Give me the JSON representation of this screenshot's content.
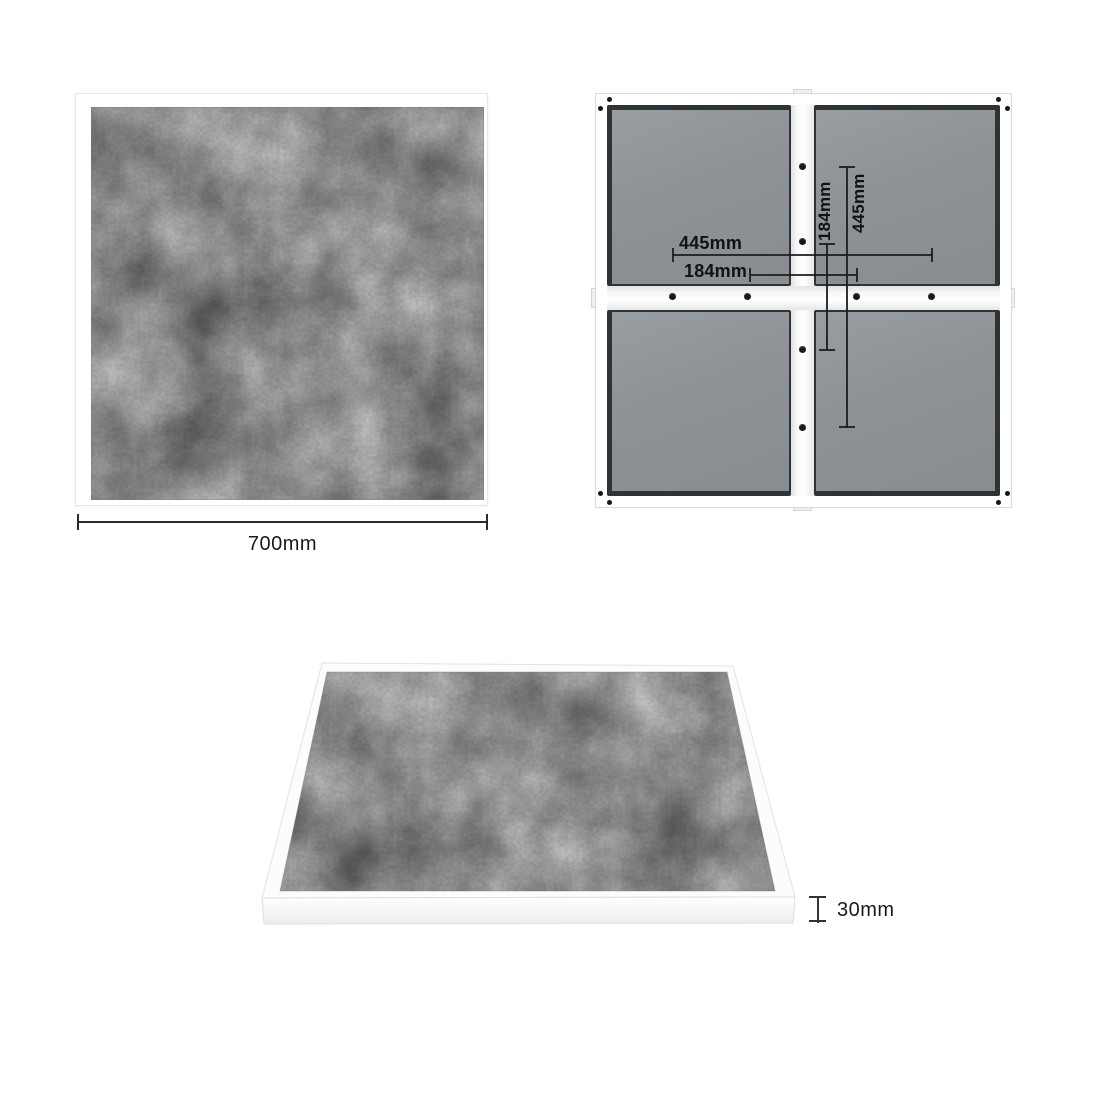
{
  "top_view": {
    "width_label": "700mm"
  },
  "underside_view": {
    "dim_horizontal_long": "445mm",
    "dim_horizontal_short": "184mm",
    "dim_vertical_short": "184mm",
    "dim_vertical_long": "445mm"
  },
  "side_view": {
    "thickness_label": "30mm"
  },
  "colors": {
    "background": "#ffffff",
    "concrete_gray": "#8f8f8f",
    "panel_gray": "#8e9296",
    "panel_border": "#2f3336",
    "rail_white": "#f5f5f5",
    "dimension_line": "#1c1c1c",
    "label_text": "#141414"
  }
}
